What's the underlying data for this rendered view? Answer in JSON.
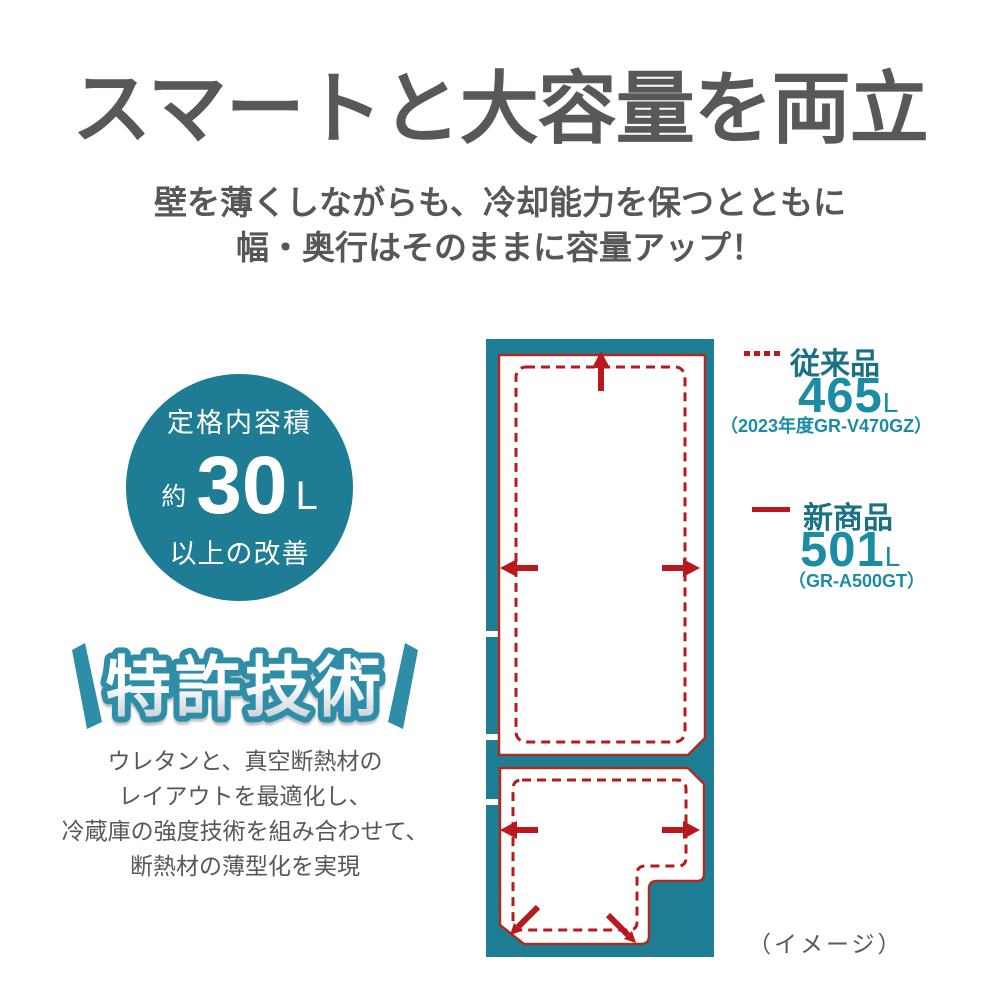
{
  "page": {
    "title": "スマートと大容量を両立",
    "subtitle_line1": "壁を薄くしながらも、冷却能力を保つとともに",
    "subtitle_line2": "幅・奥行はそのままに容量アップ！",
    "image_note": "（イメージ）"
  },
  "capacity_badge": {
    "top_label": "定格内容積",
    "prefix": "約",
    "value": "30",
    "unit": "L",
    "bottom_label": "以上の改善"
  },
  "patent_badge": {
    "label": "特許技術"
  },
  "description": {
    "lines": [
      "ウレタンと、真空断熱材の",
      "レイアウトを最適化し、",
      "冷蔵庫の強度技術を組み合わせて、",
      "断熱材の薄型化を実現"
    ]
  },
  "legend": {
    "old": {
      "label": "従来品",
      "value": "465",
      "unit": "L",
      "model": "（2023年度GR-V470GZ）",
      "line_style": "dashed"
    },
    "new": {
      "label": "新商品",
      "value": "501",
      "unit": "L",
      "model": "（GR-A500GT）",
      "line_style": "solid"
    }
  },
  "diagram": {
    "name": "refrigerator-capacity-comparison",
    "old_interior_style": "red-dashed-outline",
    "new_interior_style": "red-solid-outline",
    "arrow_meaning": "interior-expansion-direction"
  },
  "colors": {
    "teal_body": "#1e7d94",
    "teal_badge_outline": "#2e8ea8",
    "teal_value_text": "#1b8ca3",
    "teal_label_text": "#1a7186",
    "red_accent": "#b9191e",
    "red_outline": "#ab2d20",
    "gray_text": "#595757"
  }
}
